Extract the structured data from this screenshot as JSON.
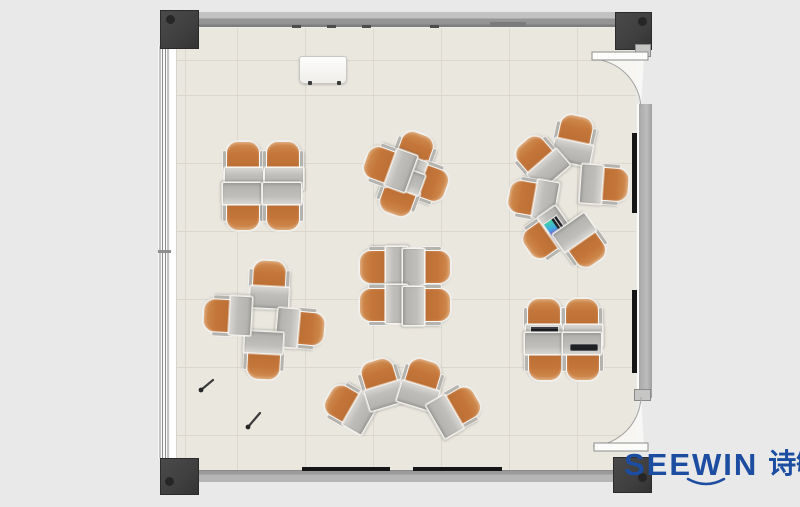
{
  "branding": {
    "logo_text": "SEEWIN",
    "logo_cn": "诗敏",
    "logo_color": "#1c4da0"
  },
  "palette": {
    "background": "#e9e9e9",
    "floor": "#eae7df",
    "grid_line": "#dcd8ce",
    "wall_gray": "#b1b1b1",
    "column_dark": "#3f3f3f",
    "chair_orange": "#c4763a",
    "desk_gray": "#bfbebb",
    "screen_dark": "#161616",
    "accent_blue": "#1c4da0"
  },
  "scene": {
    "description": "classroom floor plan, units are [x,y,rotation_deg,items]",
    "clusters": [
      {
        "name": "pod-top-left",
        "units": [
          [
            243,
            165,
            0
          ],
          [
            283,
            165,
            0
          ],
          [
            243,
            207,
            180
          ],
          [
            283,
            207,
            180
          ]
        ]
      },
      {
        "name": "pinwheel-top-center",
        "units": [
          [
            413,
            156,
            20
          ],
          [
            424,
            181,
            110
          ],
          [
            400,
            192,
            200
          ],
          [
            388,
            167,
            290
          ]
        ]
      },
      {
        "name": "circle-right",
        "units": [
          [
            574,
            139,
            12
          ],
          [
            539,
            160,
            -41
          ],
          [
            605,
            184,
            94
          ],
          [
            532,
            199,
            280
          ],
          [
            547,
            236,
            235,
            [
              "tablet"
            ]
          ],
          [
            583,
            243,
            145
          ]
        ]
      },
      {
        "name": "pod-center",
        "units": [
          [
            383,
            267,
            270
          ],
          [
            427,
            267,
            90
          ],
          [
            383,
            305,
            270
          ],
          [
            427,
            305,
            90
          ]
        ]
      },
      {
        "name": "pinwheel-left",
        "units": [
          [
            269,
            284,
            3
          ],
          [
            301,
            328,
            95
          ],
          [
            264,
            356,
            183
          ],
          [
            227,
            316,
            273
          ]
        ]
      },
      {
        "name": "fan-bottom",
        "units": [
          [
            349,
            407,
            300
          ],
          [
            381,
            383,
            343
          ],
          [
            421,
            383,
            17
          ],
          [
            456,
            409,
            60
          ]
        ]
      },
      {
        "name": "pod-bottom-right",
        "units": [
          [
            544,
            322,
            0,
            [
              "laptop",
              "book"
            ]
          ],
          [
            582,
            322,
            0
          ],
          [
            545,
            357,
            180
          ],
          [
            583,
            357,
            180,
            [
              "closedlaptop"
            ]
          ]
        ]
      }
    ]
  }
}
